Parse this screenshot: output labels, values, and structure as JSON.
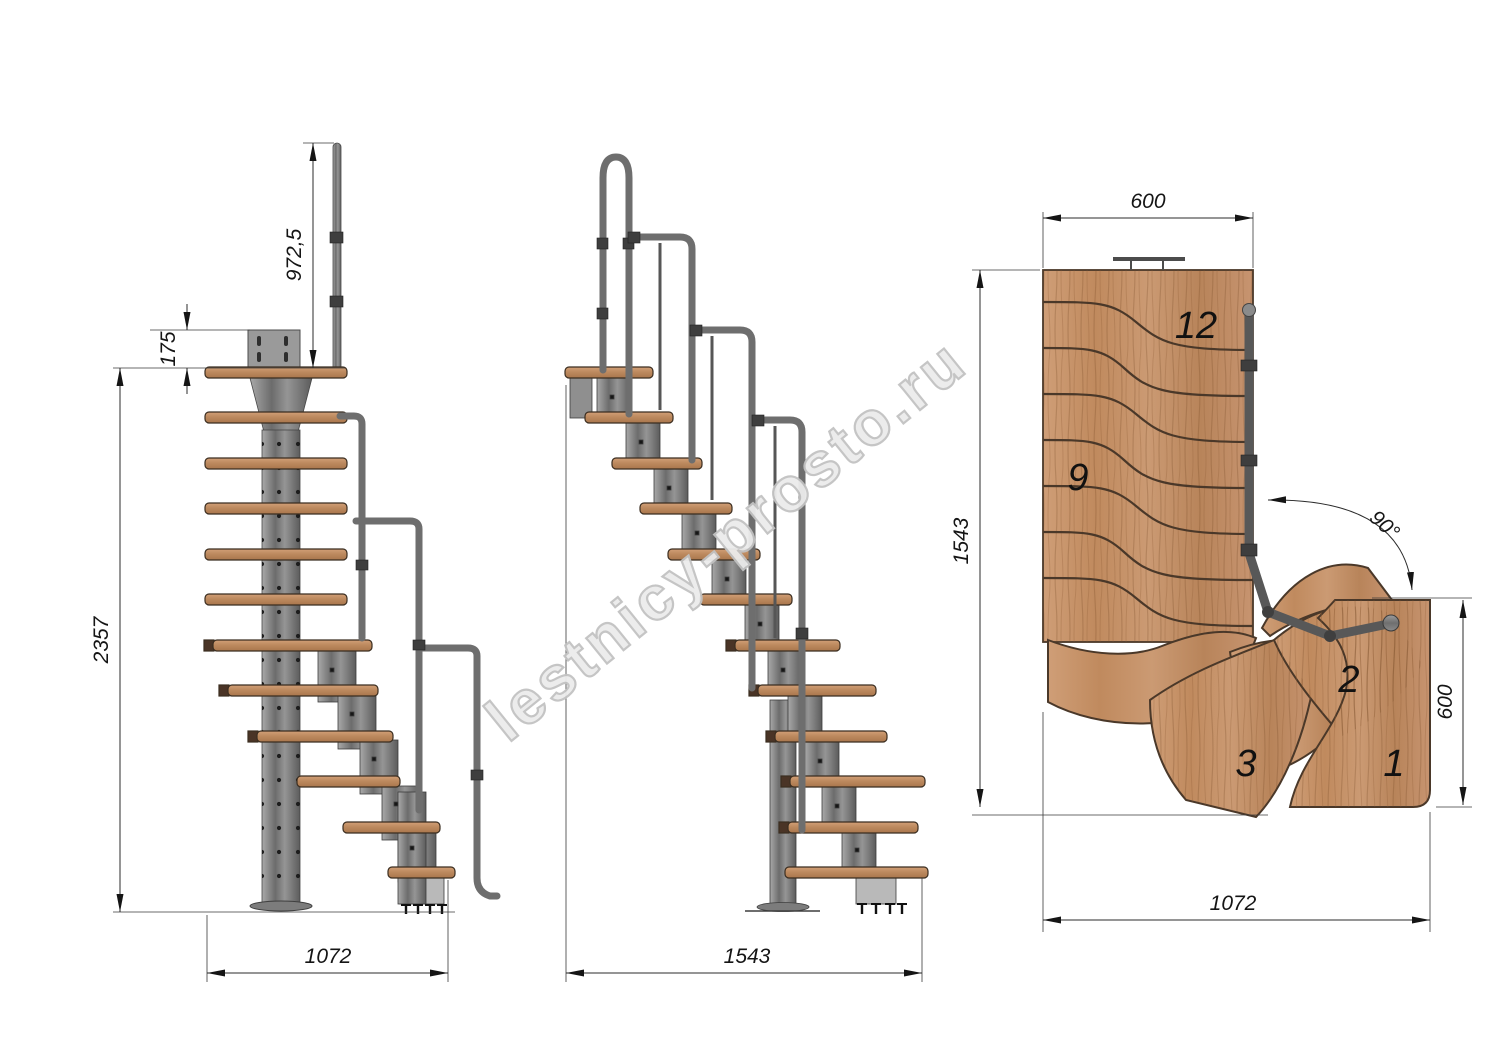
{
  "watermark": {
    "text": "lestnicy-prosto.ru"
  },
  "colors": {
    "wood": "#c6946c",
    "wood_dark": "#a87a50",
    "metal": "#7f7f7f",
    "metal_dark": "#4f4f4f",
    "dimension_line": "#2b2b2b",
    "watermark": "#c2c2c2"
  },
  "views": {
    "side": {
      "label": "side-elevation",
      "dims": {
        "rail_height": "972,5",
        "top_bracket": "175",
        "overall_height": "2357",
        "footprint": "1072"
      }
    },
    "front": {
      "label": "front-elevation",
      "dims": {
        "footprint": "1543"
      }
    },
    "plan": {
      "label": "top-plan",
      "dims": {
        "flight_width": "600",
        "flight_length": "1543",
        "turn_angle": "90°",
        "entry_length": "600",
        "overall_width": "1072"
      },
      "steps": {
        "n12": "12",
        "n9": "9",
        "n3": "3",
        "n2": "2",
        "n1": "1"
      }
    }
  }
}
